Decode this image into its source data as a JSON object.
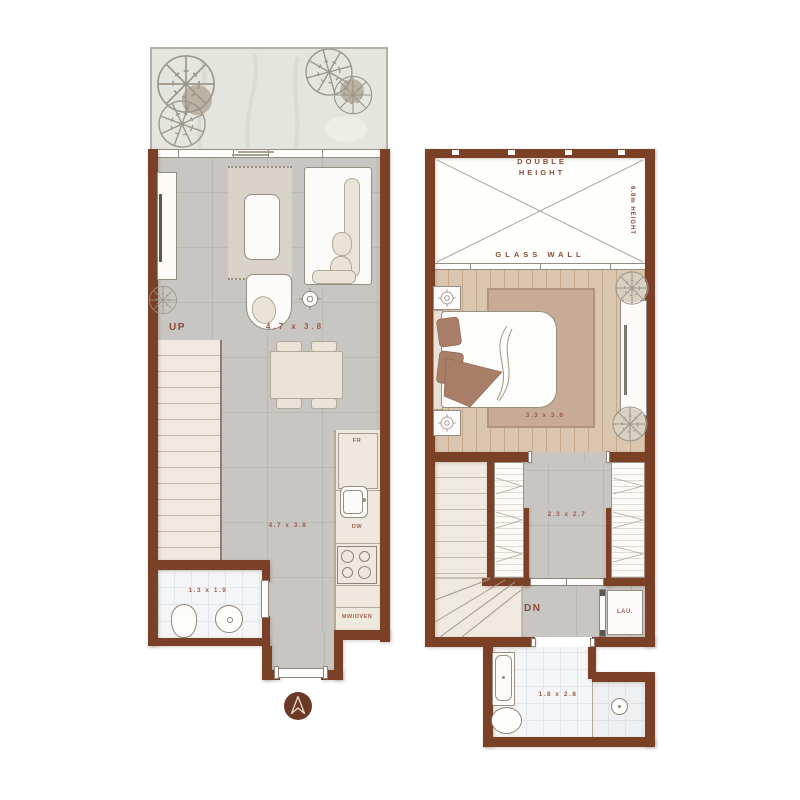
{
  "plan_type": "two-level apartment floor plan",
  "colors": {
    "wall": "#7b4127",
    "accent_label": "#8a4a35",
    "dimension_label": "#9b5c48",
    "floor_gray": "#c8c6c2",
    "wood_floor": "#dac6ae",
    "stair_tread": "#f0e9df",
    "bath_tile": "#f3f5f7",
    "bedroom_rug": "#c8ab97",
    "pillow_brown": "#a87e69",
    "compass": "#6b3a27",
    "terrace": "#e4e5df"
  },
  "floor1": {
    "up": "UP",
    "living_dim": "4.7 x 3.8",
    "kitchen_dim": "4.7 x 3.8",
    "bath_dim": "1.3 x 1.9",
    "fridge": "FR",
    "dishwasher": "DW",
    "microwave_oven": "MW/OVEN"
  },
  "floor2": {
    "double_height_1": "DOUBLE",
    "double_height_2": "HEIGHT",
    "ceiling_height": "6.8m HEIGHT",
    "glass_wall": "GLASS WALL",
    "bedroom_dim": "3.3 x 3.8",
    "dressing_dim": "2.3 x 2.7",
    "down": "DN",
    "laundry": "LAU.",
    "bath_dim": "1.8 x 2.8"
  }
}
